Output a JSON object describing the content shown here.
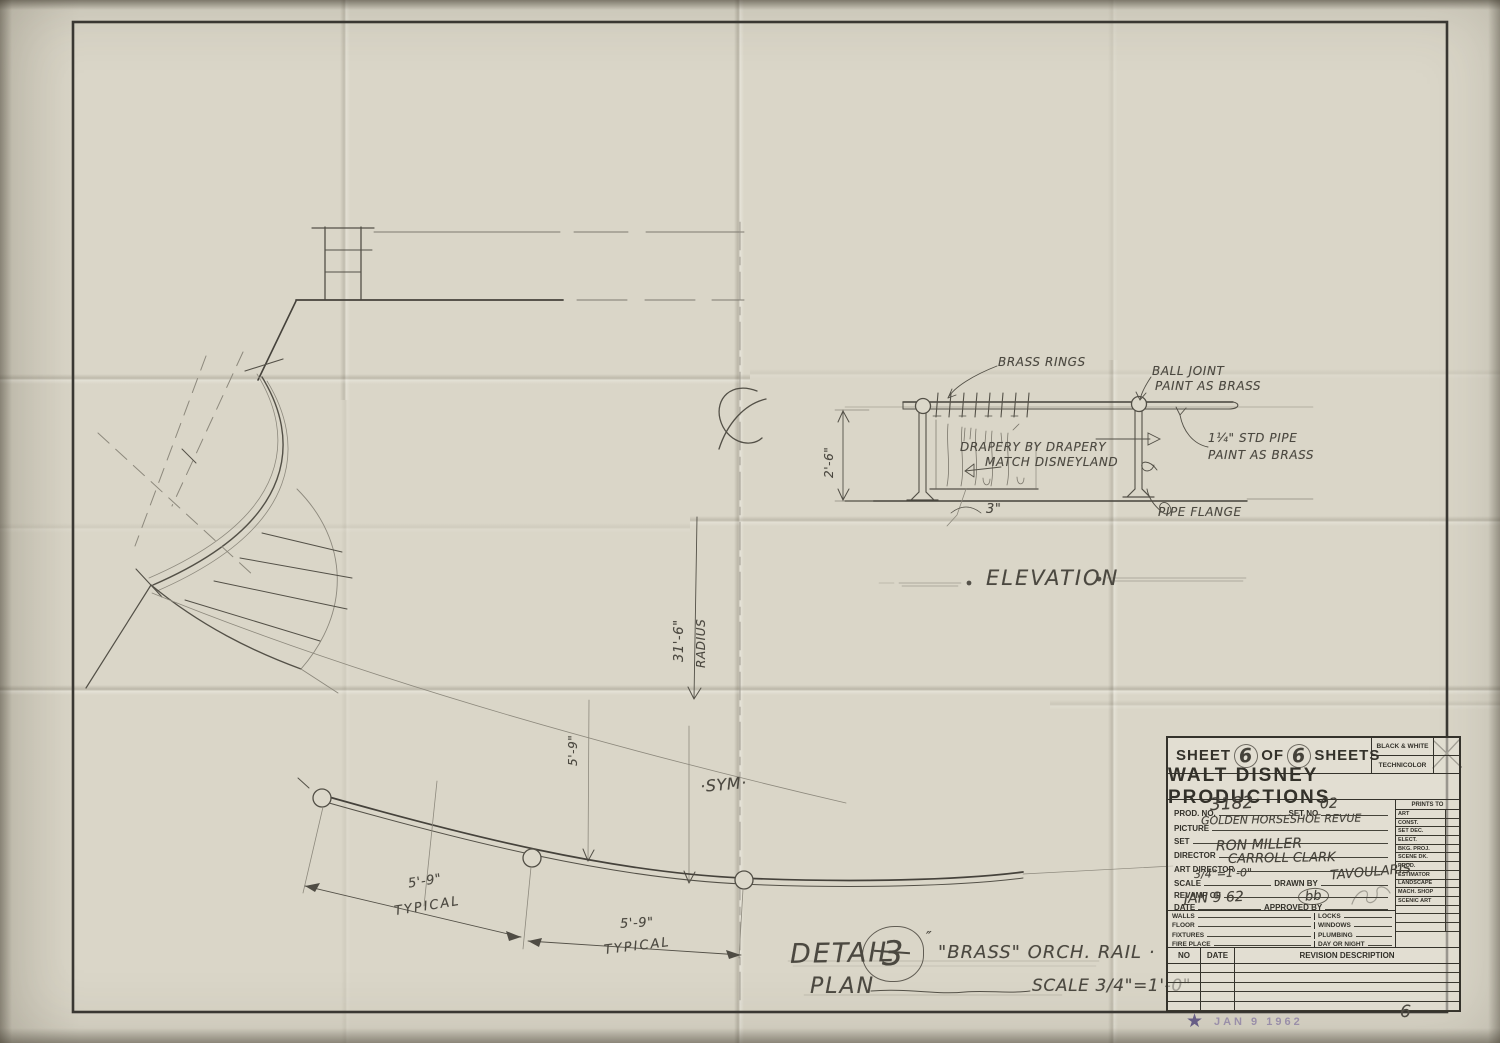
{
  "sheet": {
    "page_number": "6"
  },
  "stamp": {
    "star": "★",
    "date": "JAN 9 1962"
  },
  "plan": {
    "centerline_symbol": "℄",
    "radius_dim": "31'-6\"",
    "radius_word": "RADIUS",
    "rail_spacing_rot": "5'-9\"",
    "spacing_a": "5'-9\"",
    "typical_a": "TYPICAL",
    "spacing_b": "5'-9\"",
    "typical_b": "TYPICAL",
    "sym": "·SYM·"
  },
  "elevation": {
    "title": "ELEVATION",
    "brass_rings": "BRASS RINGS",
    "ball_joint_line1": "BALL JOINT",
    "ball_joint_line2": "PAINT AS BRASS",
    "drapery_line1": "DRAPERY BY DRAPERY",
    "drapery_line2": "MATCH DISNEYLAND",
    "pipe_line1": "1¼\" STD PIPE",
    "pipe_line2": "PAINT AS BRASS",
    "pipe_flange": "PIPE FLANGE",
    "height_dim": "2'-6\"",
    "hem_dim": "3\""
  },
  "detail": {
    "word": "DETAIL",
    "number": "3",
    "number_suffix": "″",
    "title": "\"BRASS\" ORCH. RAIL ·",
    "plan_word": "PLAN",
    "scale": "SCALE 3/4\"=1'-0\""
  },
  "title_block": {
    "sheet_line": {
      "sheet": "SHEET",
      "num1": "6",
      "of": "OF",
      "num2": "6",
      "sheets": "SHEETS"
    },
    "color_options": {
      "bw": "BLACK & WHITE",
      "tech": "TECHNICOLOR"
    },
    "company": "WALT DISNEY PRODUCTIONS",
    "fields": {
      "prod_no_label": "PROD. NO.",
      "prod_no": "3182",
      "set_no_label": "SET NO",
      "set_no": "02",
      "picture_label": "PICTURE",
      "picture": "GOLDEN HORSESHOE REVUE",
      "set_label": "SET",
      "director_label": "DIRECTOR",
      "director": "RON MILLER",
      "art_director_label": "ART DIRECTOR",
      "art_director": "CARROLL CLARK",
      "scale_label": "SCALE",
      "scale": "3/4\"=1'-0\"",
      "drawn_by_label": "DRAWN BY",
      "drawn_by": "TAVOULARIS",
      "revamp_label": "REVAMP OF",
      "date_label": "DATE",
      "date": "JAN 9 62",
      "approved_label": "APPROVED BY",
      "approved": "bb"
    },
    "prints_to": {
      "header": "PRINTS TO",
      "items": [
        "ART",
        "CONST.",
        "SET DEC.",
        "ELECT.",
        "BKG. PROJ.",
        "SCENE DK.",
        "PROD.",
        "ESTIMATOR",
        "LANDSCAPE",
        "MACH. SHOP",
        "SCENIC ART"
      ]
    },
    "checklist_left": [
      "WALLS",
      "FLOOR",
      "FIXTURES",
      "FIRE PLACE"
    ],
    "checklist_right": [
      "LOCKS",
      "WINDOWS",
      "PLUMBING",
      "DAY OR NIGHT"
    ],
    "revision": {
      "no": "NO",
      "date": "DATE",
      "description": "REVISION DESCRIPTION"
    }
  }
}
